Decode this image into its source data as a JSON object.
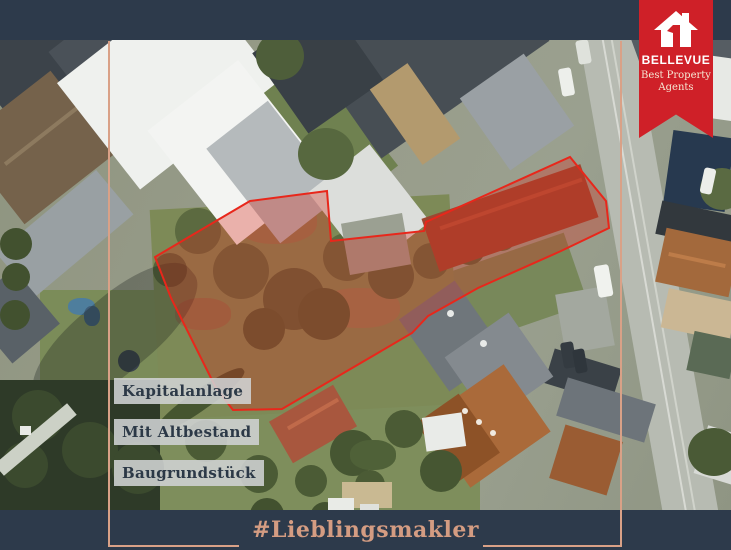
{
  "badge": {
    "brand": "BELLEVUE",
    "tagline_line1": "Best Property",
    "tagline_line2": "Agents",
    "icon": "house-logo-icon"
  },
  "overlay_labels": [
    {
      "text": "Kapitalanlage"
    },
    {
      "text": "Mit Altbestand"
    },
    {
      "text": "Baugrundstück"
    }
  ],
  "footer": {
    "hashtag": "#Lieblingsmakler"
  },
  "plot_outline": {
    "points": [
      [
        250,
        201
      ],
      [
        327,
        191
      ],
      [
        331,
        241
      ],
      [
        424,
        231
      ],
      [
        426,
        222
      ],
      [
        570,
        157
      ],
      [
        606,
        201
      ],
      [
        609,
        228
      ],
      [
        561,
        251
      ],
      [
        478,
        288
      ],
      [
        428,
        316
      ],
      [
        412,
        333
      ],
      [
        282,
        409
      ],
      [
        233,
        410
      ],
      [
        216,
        388
      ],
      [
        171,
        298
      ],
      [
        155,
        257
      ]
    ],
    "stroke_color": "#e8271b",
    "fill_color": "rgba(216,44,28,0.33)"
  },
  "colors": {
    "bar_navy": "#2d3a4b",
    "frame_line": "#d9a187",
    "hashtag_text": "#d49c82",
    "badge_red": "#cf2028",
    "label_box_bg": "rgba(208,211,212,0.88)",
    "label_text": "#2c3947"
  }
}
